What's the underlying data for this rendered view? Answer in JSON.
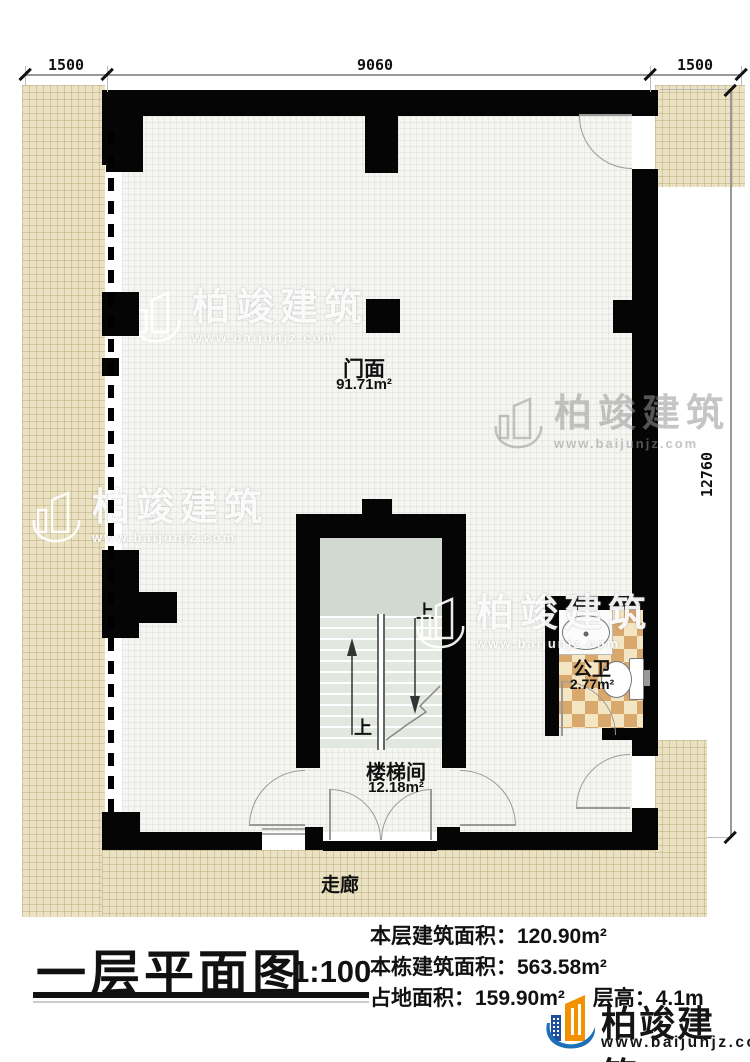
{
  "plan": {
    "dims": {
      "top_left": "1500",
      "top_center": "9060",
      "top_right": "1500",
      "right_total": "12760"
    },
    "rooms": {
      "storefront": {
        "name": "门面",
        "area": "91.71m²"
      },
      "stairwell": {
        "name": "楼梯间",
        "area": "12.18m²"
      },
      "toilet": {
        "name": "公卫",
        "area": "2.77m²"
      },
      "corridor_label": "走廊"
    },
    "stairs": {
      "up_top": "上",
      "up_bottom": "上"
    }
  },
  "title_block": {
    "title": "一层平面图",
    "scale": "1:100",
    "stats": [
      {
        "label": "本层建筑面积：",
        "value": "120.90m²"
      },
      {
        "label": "本栋建筑面积：",
        "value": "563.58m²"
      },
      {
        "label": "占地面积：",
        "value": "159.90m²"
      },
      {
        "label": "层高：",
        "value": "4.1m"
      }
    ]
  },
  "watermark": {
    "brand": "柏竣建筑",
    "url": "www.baijunjz.com"
  },
  "logo": {
    "brand": "柏竣建筑",
    "url": "www.baijunjz.com"
  },
  "colors": {
    "wall": "#050505",
    "corridor": "#ebe2c4",
    "tile_dark": "#d8a86d",
    "tile_light": "#f5e6c3",
    "stair_landing": "#d2d9d0",
    "logo_blue": "#1d6fb8",
    "logo_orange": "#f39200"
  }
}
